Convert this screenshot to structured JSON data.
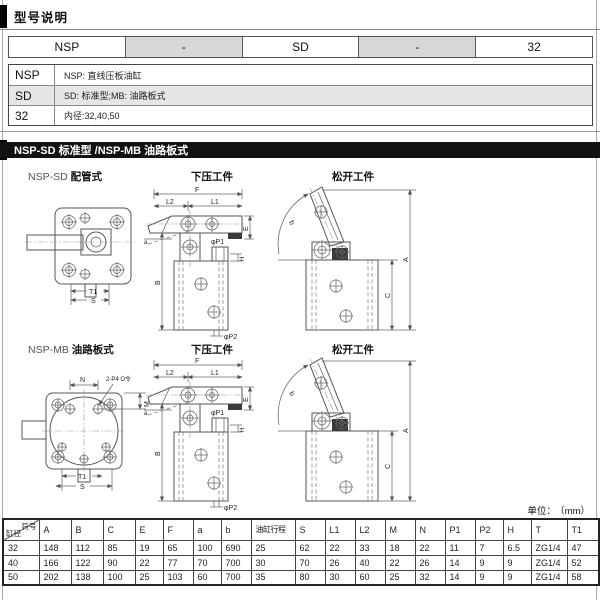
{
  "colors": {
    "section_bar_bg": "#111111",
    "model_separator_bg": "#d8d8d8",
    "legend_alt_row_bg": "#e6e6e6"
  },
  "header": {
    "title": "型号说明"
  },
  "model_code": {
    "seg1": "NSP",
    "sep1": "-",
    "seg2": "SD",
    "sep2": "-",
    "seg3": "32"
  },
  "model_legend": {
    "rows": [
      {
        "code": "NSP",
        "desc": "NSP: 直线压板油缸"
      },
      {
        "code": "SD",
        "desc": "SD: 标准型;MB: 油路板式"
      },
      {
        "code": "32",
        "desc": "内径:32,40,50"
      }
    ]
  },
  "section_bar": {
    "title": "NSP-SD 标准型 /NSP-MB 油路板式"
  },
  "drawings": {
    "row1": {
      "prefix": "NSP-SD",
      "name": "配管式"
    },
    "row2": {
      "prefix": "NSP-MB",
      "name": "油路板式"
    },
    "press_title": "下压工件",
    "release_title": "松开工件",
    "dims": {
      "F": "F",
      "L1": "L1",
      "L2": "L2",
      "E": "E",
      "B": "B",
      "H": "H",
      "P1": "φP1",
      "P2": "φP2",
      "A": "A",
      "C": "C",
      "a": "a",
      "b": "b",
      "T1": "T1",
      "S": "S",
      "N": "N",
      "M": "M",
      "port_note": "2-P4 O令"
    }
  },
  "unit_note": {
    "label": "单位：",
    "value": "（mm）"
  },
  "spec_table": {
    "corner": {
      "top": "符号",
      "bottom": "缸径"
    },
    "columns": [
      "A",
      "B",
      "C",
      "E",
      "F",
      "a",
      "b",
      "油缸行程",
      "S",
      "L1",
      "L2",
      "M",
      "N",
      "P1",
      "P2",
      "H",
      "T",
      "T1"
    ],
    "rows": [
      {
        "bore": "32",
        "values": [
          "148",
          "112",
          "85",
          "19",
          "65",
          "100",
          "690",
          "25",
          "62",
          "22",
          "33",
          "18",
          "22",
          "11",
          "7",
          "6.5",
          "ZG1/4",
          "47"
        ]
      },
      {
        "bore": "40",
        "values": [
          "166",
          "122",
          "90",
          "22",
          "77",
          "70",
          "700",
          "30",
          "70",
          "26",
          "40",
          "22",
          "26",
          "14",
          "9",
          "9",
          "ZG1/4",
          "52"
        ]
      },
      {
        "bore": "50",
        "values": [
          "202",
          "138",
          "100",
          "25",
          "103",
          "60",
          "700",
          "35",
          "80",
          "30",
          "60",
          "25",
          "32",
          "14",
          "9",
          "9",
          "ZG1/4",
          "58"
        ]
      }
    ]
  }
}
